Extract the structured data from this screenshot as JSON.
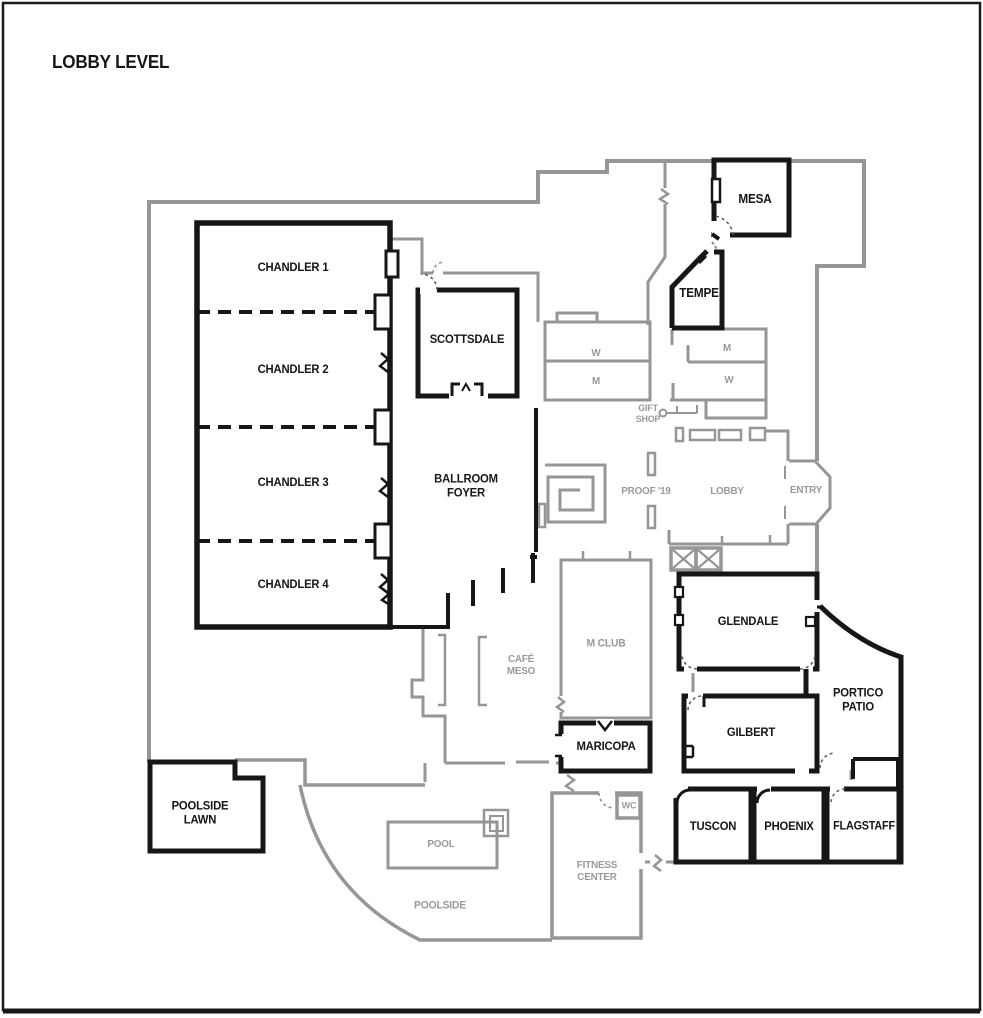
{
  "title": "LOBBY LEVEL",
  "colors": {
    "wall_black": "#161616",
    "wall_gray": "#969696",
    "label_black": "#161616",
    "label_gray": "#9a9a9a",
    "background": "#ffffff"
  },
  "rooms": {
    "chandler_1": "CHANDLER 1",
    "chandler_2": "CHANDLER 2",
    "chandler_3": "CHANDLER 3",
    "chandler_4": "CHANDLER 4",
    "scottsdale": "SCOTTSDALE",
    "ballroom_foyer": "BALLROOM\nFOYER",
    "mesa": "MESA",
    "tempe": "TEMPE",
    "glendale": "GLENDALE",
    "gilbert": "GILBERT",
    "portico_patio": "PORTICO\nPATIO",
    "maricopa": "MARICOPA",
    "tuscon": "TUSCON",
    "phoenix": "PHOENIX",
    "flagstaff": "FLAGSTAFF",
    "poolside_lawn": "POOLSIDE\nLAWN",
    "m_club": "M CLUB",
    "cafe_meso": "CAFÉ\nMESO",
    "w_left": "W",
    "m_left": "M",
    "m_right": "M",
    "w_right": "W",
    "gift_shop": "GIFT\nSHOP",
    "proof": "PROOF '19",
    "lobby": "LOBBY",
    "entry": "ENTRY",
    "pool": "POOL",
    "poolside": "POOLSIDE",
    "fitness_center": "FITNESS\nCENTER",
    "wc": "WC"
  }
}
